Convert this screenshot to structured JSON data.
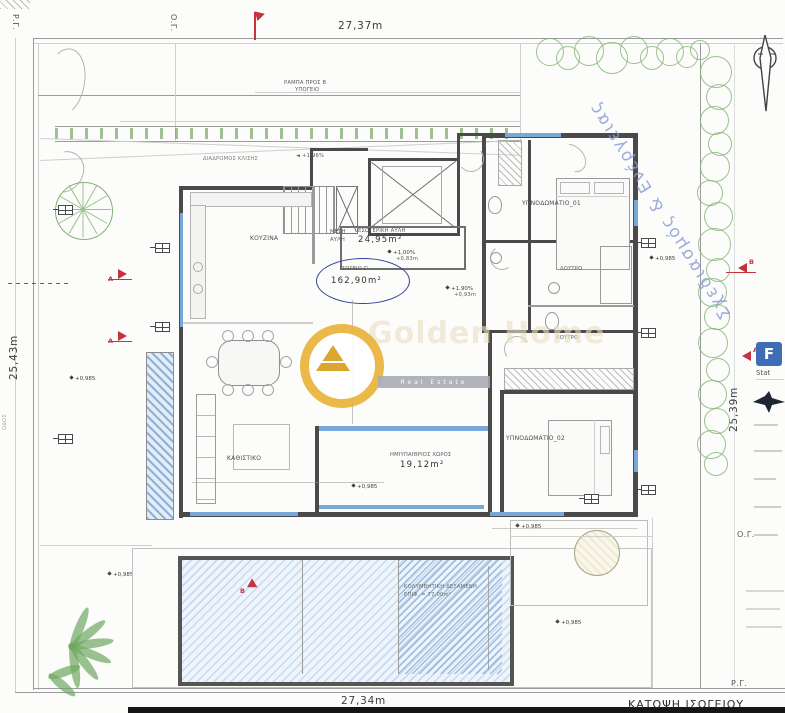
{
  "drawing": {
    "title": "ΚΑΤΟΨΗ ΙΣΟΓΕΙΟΥ",
    "dims": {
      "top": "27,37m",
      "bottom": "27,34m",
      "left": "25,43m",
      "right": "25,39m"
    },
    "gridlines": {
      "pg_top": "Ρ.Γ.",
      "og_top": "Ο.Γ.",
      "og_right": "Ο.Γ.",
      "pg_bottom": "Ρ.Γ."
    },
    "street": "ΟΔΟΣ"
  },
  "rooms": {
    "kitchen": "ΚΟΥΖΙΝΑ",
    "living": "ΚΑΘΙΣΤΙΚΟ",
    "bedroom1": "ΥΠΝΟΔΩΜΑΤΙΟ_01",
    "bedroom2": "ΥΠΝΟΔΩΜΑΤΙΟ_02",
    "bath1": "ΛΟΥΤΡΟ",
    "bath2": "ΛΟΥΤΡΟ",
    "atrium": {
      "label": "ΕΣΩΤΕΡΙΚΗ ΑΥΛΗ",
      "area": "24,95m²",
      "side1": "ΜΕΣΗ",
      "side2": "ΑΥΛΗ"
    },
    "ground": {
      "label": "ΙΣΟΓΕΙΟ Γ'",
      "area": "162,90m²"
    },
    "semi": {
      "label": "ΗΜΙΥΠΑΙΘΡΙΟΣ ΧΩΡΟΣ",
      "area": "19,12m²"
    },
    "pool": {
      "line1": "ΚΟΛΥΜΒΗΤΙΚΗ ΔΕΞΑΜΕΝΗ",
      "line2": "ΕΠΙΦ. = 77,00m²"
    }
  },
  "annotations": {
    "ramp1": "ΡΑΜΠΑ ΠΡΟΣ Β",
    "ramp2": "ΥΠΟΓΕΙΟ",
    "driveway": "ΔΙΑΔΡΟΜΟΣ ΚΛΙΣΗΣ",
    "slope": "+1,96%",
    "elev": "+0,985",
    "grade1": "+1,00%",
    "grade1b": "+0,83m",
    "grade2": "+1,90%",
    "grade2b": "+0,93m"
  },
  "markers": {
    "a": "A",
    "b": "B"
  },
  "watermark": {
    "diagonal": "Σχεδιασμός & Ενέργειας",
    "brand": "Golden Home",
    "bar": "Real Estate"
  },
  "panel": {
    "logo": "F",
    "caption": "Stat"
  }
}
